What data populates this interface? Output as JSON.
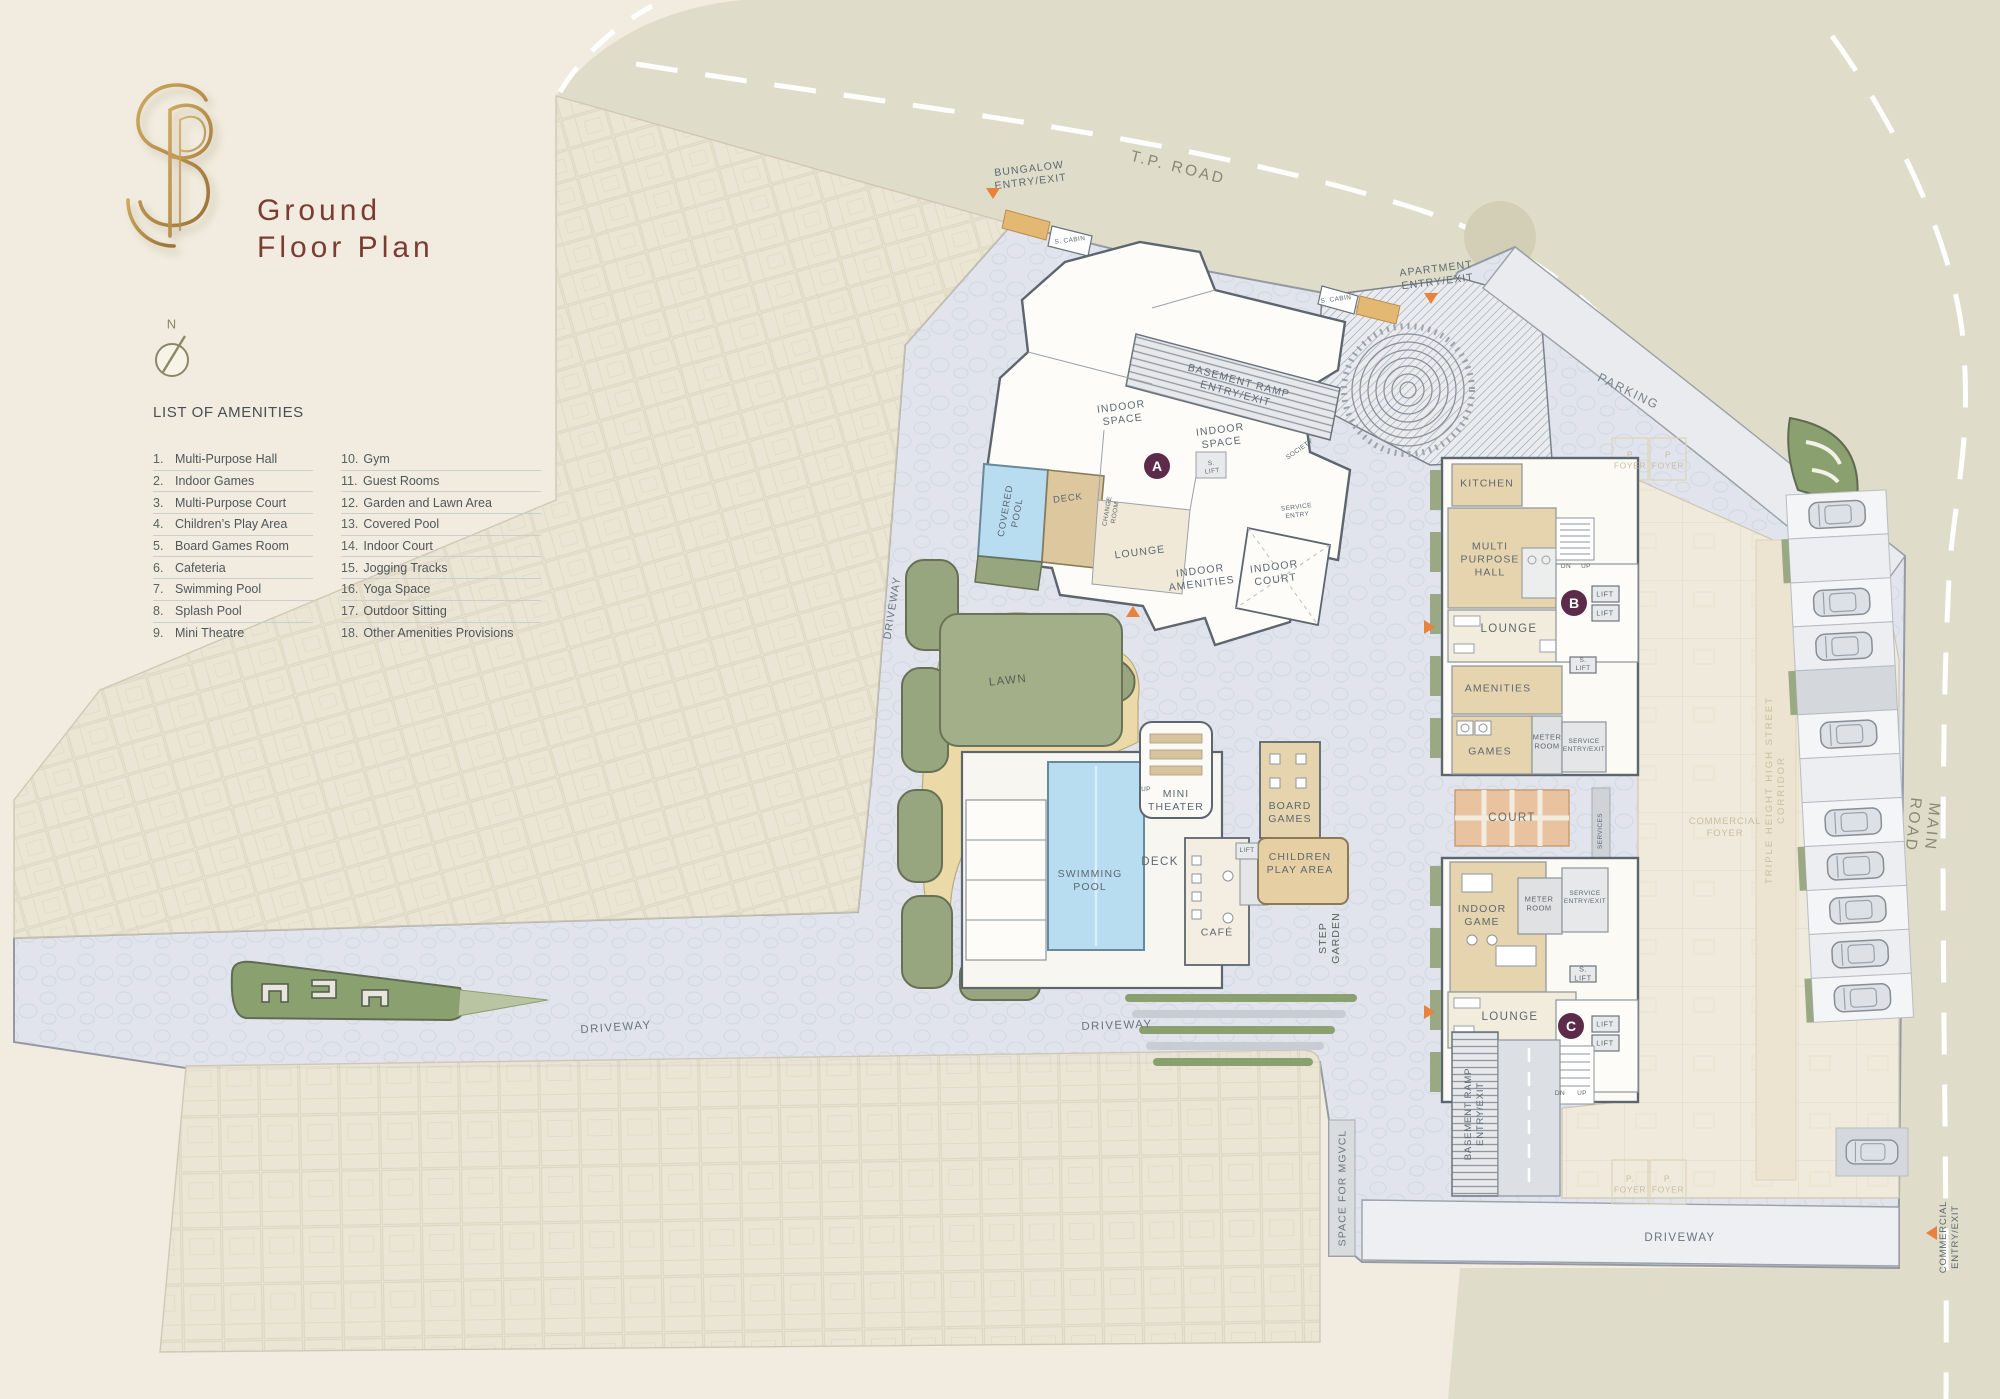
{
  "header": {
    "title_line1": "Ground",
    "title_line2": "Floor  Plan",
    "monogram": "PS"
  },
  "compass": {
    "north": "N"
  },
  "amenities": {
    "heading": "LIST OF AMENITIES",
    "col1": [
      {
        "num": "1.",
        "label": "Multi-Purpose Hall"
      },
      {
        "num": "2.",
        "label": "Indoor Games"
      },
      {
        "num": "3.",
        "label": "Multi-Purpose Court"
      },
      {
        "num": "4.",
        "label": "Children’s Play Area"
      },
      {
        "num": "5.",
        "label": "Board Games Room"
      },
      {
        "num": "6.",
        "label": "Cafeteria"
      },
      {
        "num": "7.",
        "label": "Swimming Pool"
      },
      {
        "num": "8.",
        "label": "Splash Pool"
      },
      {
        "num": "9.",
        "label": "Mini Theatre"
      }
    ],
    "col2": [
      {
        "num": "10.",
        "label": "Gym"
      },
      {
        "num": "11.",
        "label": "Guest Rooms"
      },
      {
        "num": "12.",
        "label": "Garden and Lawn Area"
      },
      {
        "num": "13.",
        "label": "Covered Pool"
      },
      {
        "num": "14.",
        "label": "Indoor Court"
      },
      {
        "num": "15.",
        "label": "Jogging Tracks"
      },
      {
        "num": "16.",
        "label": "Yoga Space"
      },
      {
        "num": "17.",
        "label": "Outdoor Sitting"
      },
      {
        "num": "18.",
        "label": "Other Amenities Provisions"
      }
    ]
  },
  "map": {
    "roads": {
      "tp_road": "T.P. ROAD",
      "main_road": "MAIN ROAD",
      "parking": "PARKING"
    },
    "driveways": {
      "left": "DRIVEWAY",
      "mid": "DRIVEWAY",
      "right": "DRIVEWAY",
      "vertical": "DRIVEWAY"
    },
    "entries": {
      "bungalow": "BUNGALOW\nENTRY/EXIT",
      "apartment": "APARTMENT\nENTRY/EXIT",
      "commercial": "COMMERCIAL\nENTRY/EXIT"
    },
    "site": {
      "space_mgvcl": "SPACE FOR MGVCL",
      "lawn": "LAWN",
      "step_garden": "STEP\nGARDEN",
      "court": "COURT"
    },
    "building_a": {
      "badge": "A",
      "basement_ramp": "BASEMENT RAMP\nENTRY/EXIT",
      "indoor_space_1": "INDOOR\nSPACE",
      "indoor_space_2": "INDOOR\nSPACE",
      "covered_pool": "COVERED\nPOOL",
      "deck": "DECK",
      "change_room": "CHANGE\nROOM",
      "lounge": "LOUNGE",
      "indoor_amenities": "INDOOR\nAMENITIES",
      "indoor_court": "INDOOR\nCOURT",
      "society": "SOCIETY",
      "service_entry": "SERVICE\nENTRY",
      "s_lift": "S.\nLIFT",
      "s_cabin_1": "S. CABIN",
      "s_cabin_2": "S. CABIN"
    },
    "central": {
      "mini_theater": "MINI\nTHEATER",
      "board_games": "BOARD\nGAMES",
      "children_play": "CHILDREN\nPLAY AREA",
      "swimming_pool": "SWIMMING\nPOOL",
      "deck": "DECK",
      "cafe": "CAFÉ",
      "lift": "LIFT",
      "up": "UP"
    },
    "building_b": {
      "badge": "B",
      "kitchen": "KITCHEN",
      "multi_purpose_hall": "MULTI\nPURPOSE\nHALL",
      "lounge": "LOUNGE",
      "amenities": "AMENITIES",
      "games": "GAMES",
      "meter_room": "METER\nROOM",
      "service_entry": "SERVICE\nENTRY/EXIT",
      "lift1": "LIFT",
      "lift2": "LIFT",
      "s_lift": "S.\nLIFT",
      "dn": "DN",
      "up": "UP",
      "p_foyer_1": "P\nFOYER",
      "p_foyer_2": "P\nFOYER"
    },
    "building_c": {
      "badge": "C",
      "indoor_game": "INDOOR\nGAME",
      "meter_room": "METER\nROOM",
      "service_entry": "SERVICE\nENTRY/EXIT",
      "lounge": "LOUNGE",
      "lift1": "LIFT",
      "lift2": "LIFT",
      "s_lift": "S.\nLIFT",
      "dn": "DN",
      "up": "UP",
      "basement_ramp": "BASEMENT RAMP\nENTRY/EXIT",
      "services": "SERVICES",
      "p_foyer_1": "P.\nFOYER",
      "p_foyer_2": "P.\nFOYER"
    },
    "commercial": {
      "foyer": "COMMERCIAL\nFOYER",
      "corridor": "TRIPLE HEIGHT HIGH STREET CORRIDOR"
    },
    "colors": {
      "accent_maroon": "#7b3c34",
      "badge_plum": "#5c2b4a",
      "gold": "#bb9254",
      "entry_orange": "#e8823c",
      "road": "#dfddc9",
      "paving": "#e1e4ec",
      "pool_blue": "#b9ddf0",
      "court_orange": "#e9c3a0",
      "green": "#97a67f",
      "room_tan": "#e6d4ae"
    }
  }
}
